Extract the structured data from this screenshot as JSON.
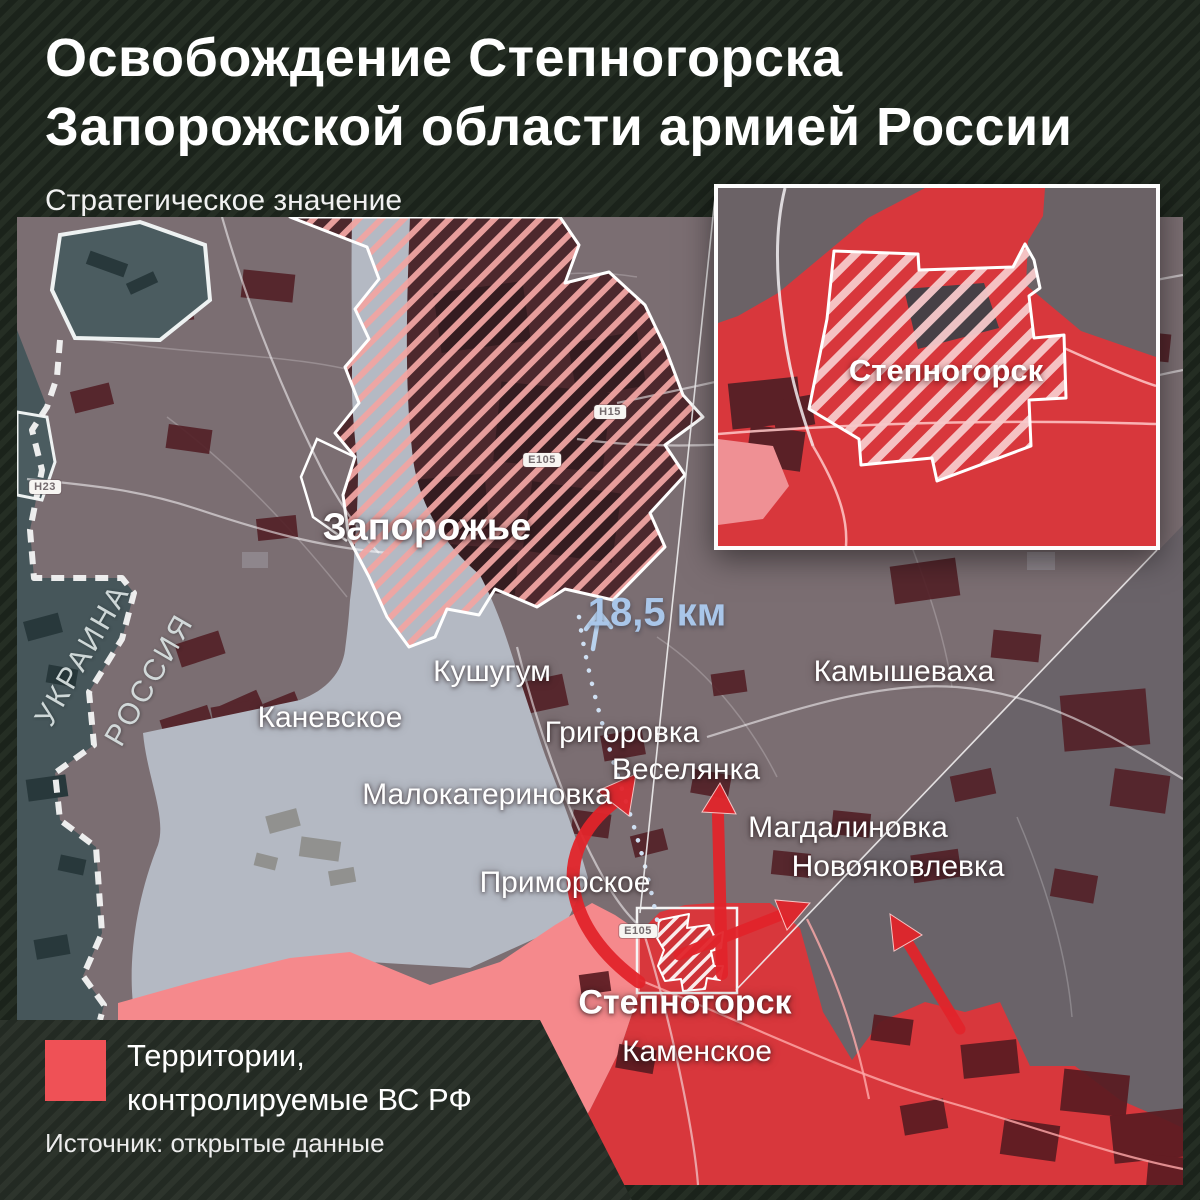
{
  "header": {
    "title_line1": "Освобождение Степногорска",
    "title_line2": "Запорожской области армией России",
    "subtitle": "Стратегическое значение"
  },
  "map": {
    "labels": [
      {
        "text": "Запорожье"
      },
      {
        "text": "Кушугум"
      },
      {
        "text": "Каневское"
      },
      {
        "text": "Григоровка"
      },
      {
        "text": "Веселянка"
      },
      {
        "text": "Малокатериновка"
      },
      {
        "text": "Приморское"
      },
      {
        "text": "Камышеваха"
      },
      {
        "text": "Магдалиновка"
      },
      {
        "text": "Новояковлевка"
      },
      {
        "text": "Степногорск"
      },
      {
        "text": "Каменское"
      },
      {
        "text": "УКРАИНА"
      },
      {
        "text": "РОССИЯ"
      }
    ],
    "distance_label": "18,5 км",
    "road_badges": [
      "H23",
      "H15",
      "E105",
      "E105"
    ],
    "inset": {
      "city_label": "Степногорск"
    }
  },
  "legend": {
    "label_line1": "Территории,",
    "label_line2": "контролируемые ВС РФ",
    "source": "Источник: открытые данные"
  },
  "colors": {
    "bg-dark": "#1b231b",
    "bg-stripe": "#252e24",
    "land": "#7b6e72",
    "land-east": "#6a6369",
    "ukraine-teal": "#46565a",
    "water": "#b4b9c3",
    "rf-red": "#d8373c",
    "rf-pink": "#f5898c",
    "field-maroon": "#532128",
    "hatch-stripe": "#f0a4a2",
    "legend-red": "#ef5156",
    "distance-blue": "#a9c6e9",
    "arrow-red": "#e2242b"
  }
}
